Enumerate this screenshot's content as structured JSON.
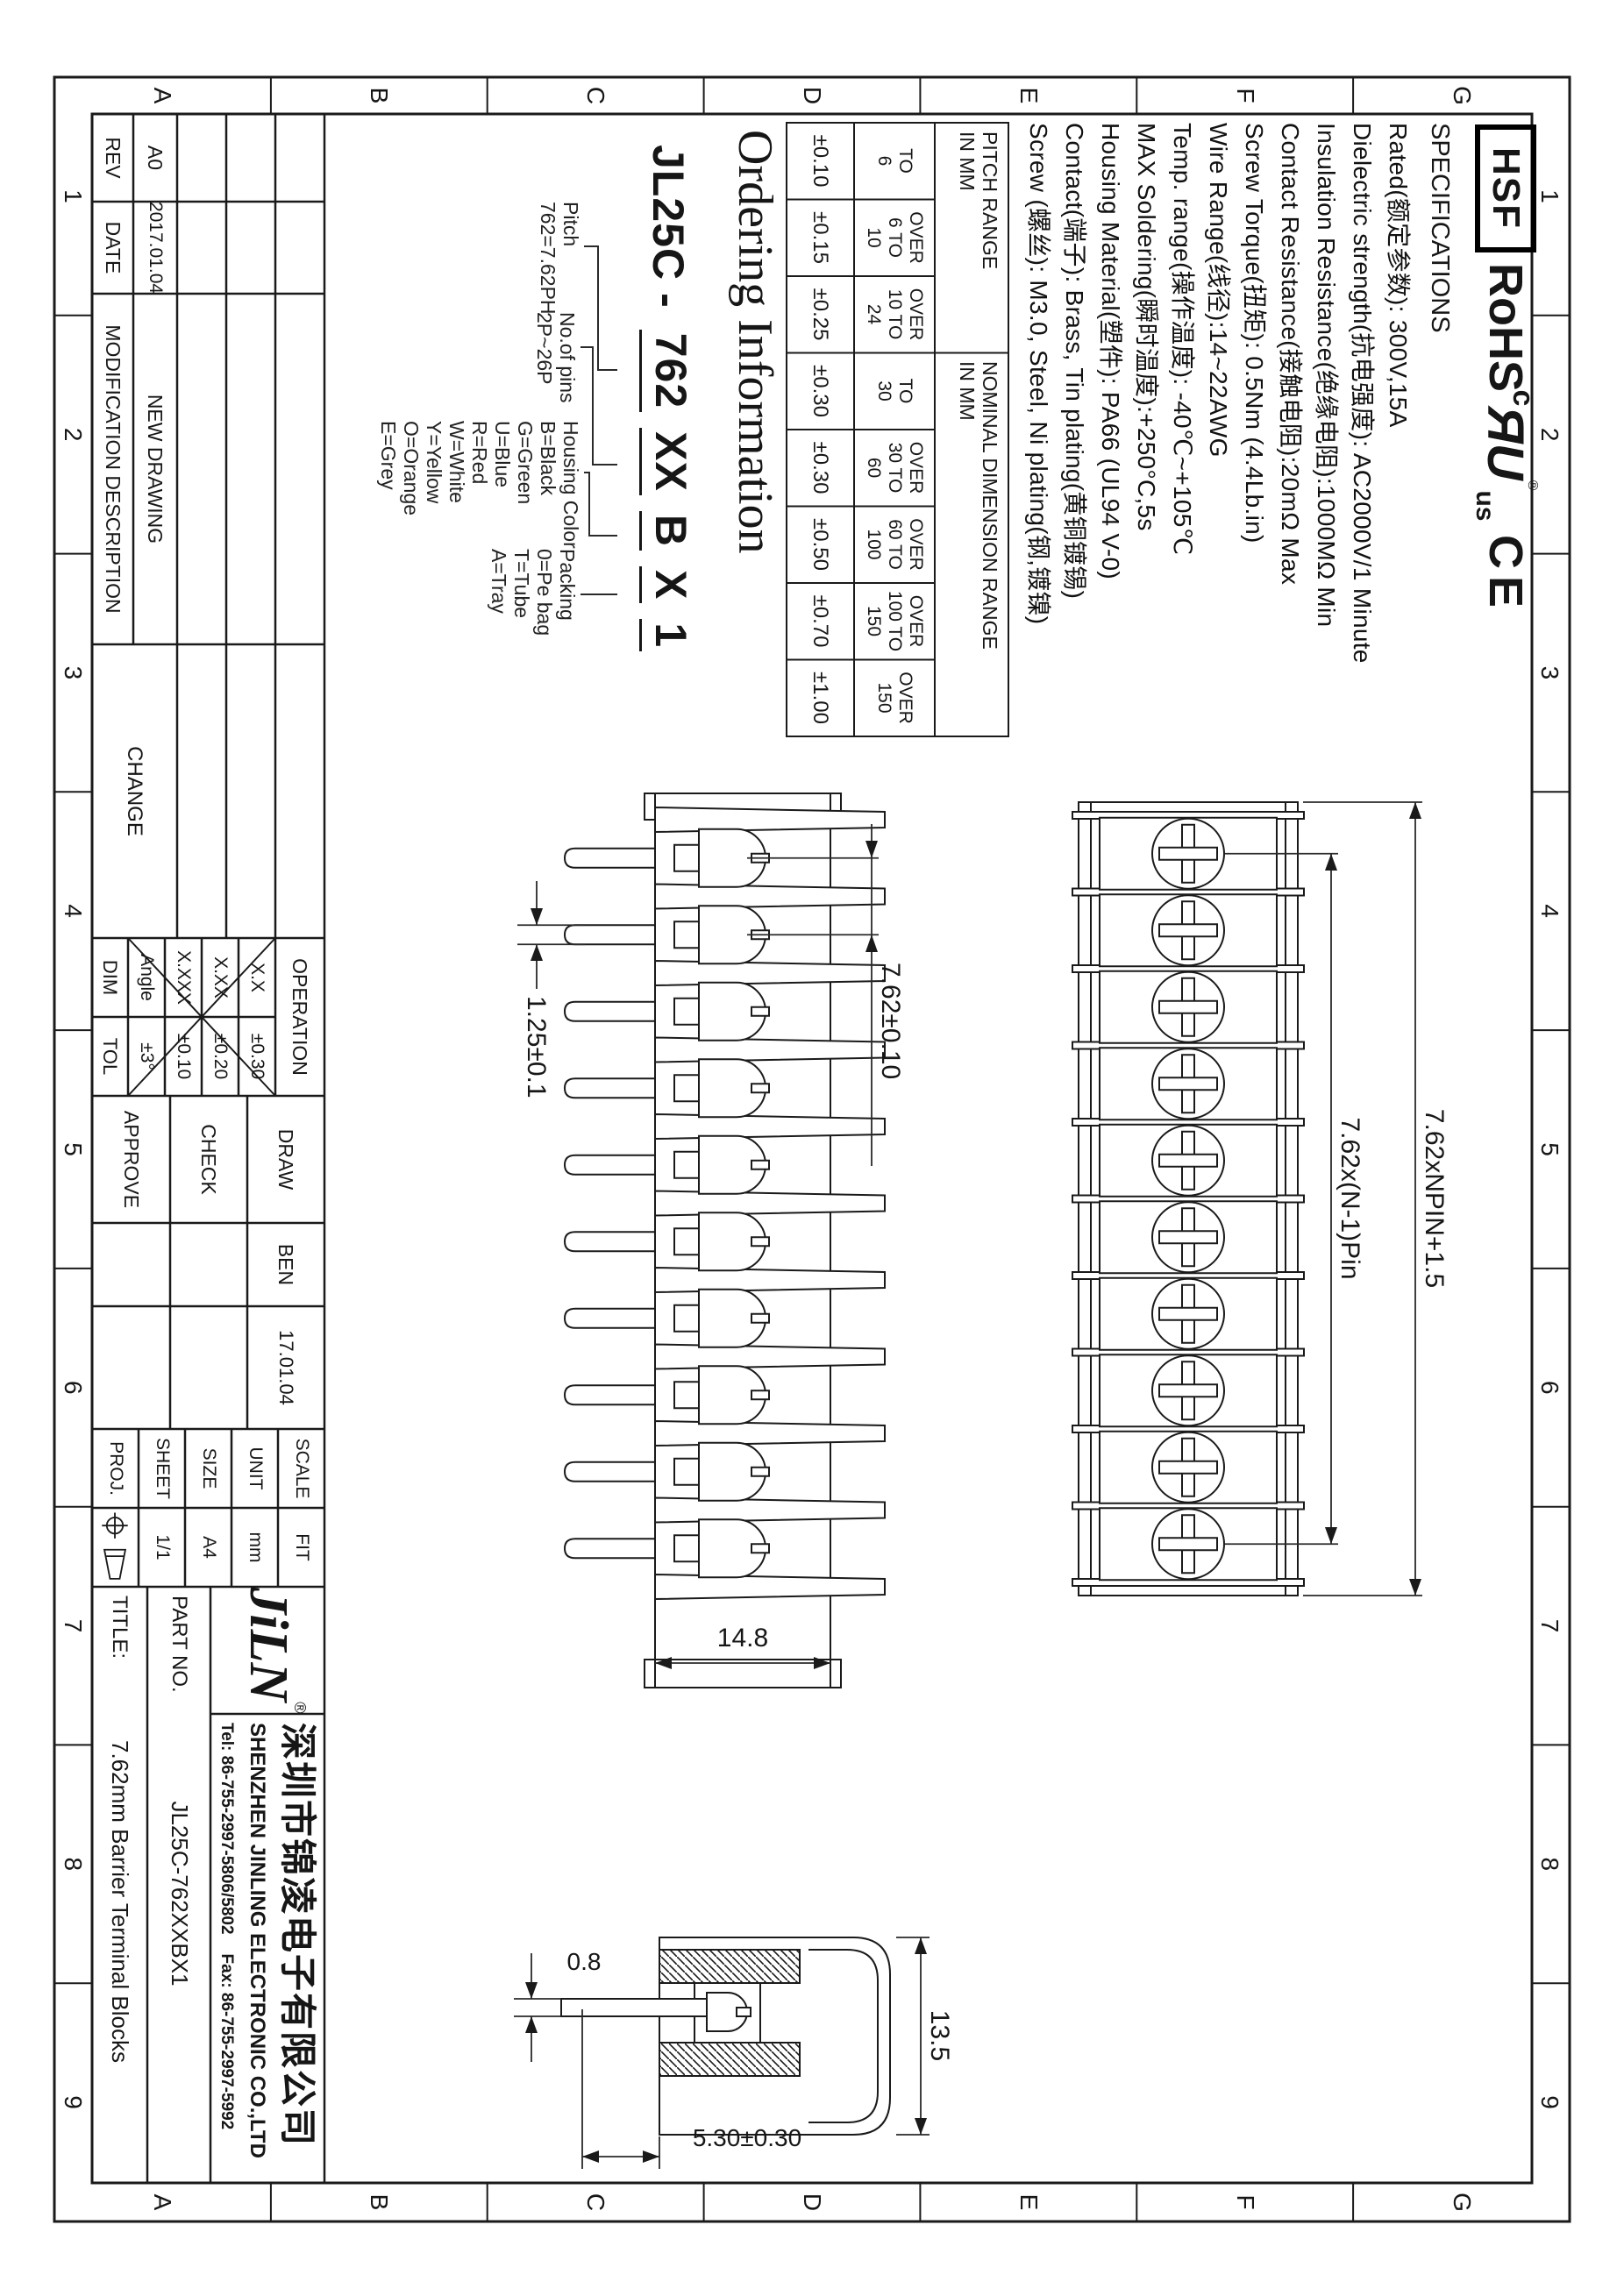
{
  "zones": {
    "letters": [
      "A",
      "B",
      "C",
      "D",
      "E",
      "F",
      "G"
    ],
    "numbers": [
      "1",
      "2",
      "3",
      "4",
      "5",
      "6",
      "7",
      "8",
      "9"
    ]
  },
  "logos": {
    "hsf": "HSF",
    "rohs": "RoHS",
    "ul_c": "c",
    "ul_ru": "ЯU",
    "ul_reg": "®",
    "ul_us": "us",
    "ce": "CE"
  },
  "specs": {
    "title": "SPECIFICATIONS",
    "lines": [
      "Rated(额定参数): 300V,15A",
      "Dielectric strength(抗电强度): AC2000V/1 Minute",
      "Insulation Resistance(绝缘电阻):1000MΩ Min",
      "Contact Resistance(接触电阻):20mΩ Max",
      "Screw Torque(扭矩): 0.5Nm (4.4Lb.in)",
      "Wire Range(线径):14~22AWG",
      "Temp. range(操作温度): -40℃~+105℃",
      "MAX Soldering(瞬时温度):+250°C,5s",
      "Housing Material(塑件): PA66 (UL94 V-0)",
      "Contact(端子): Brass, Tin plating(黄铜镀锡)",
      "Screw (螺丝): M3.0, Steel, Ni plating(钢,镀镍)"
    ]
  },
  "range_table": {
    "pitch_header": "PITCH RANGE\nIN MM",
    "nominal_header": "NOMINAL DIMENSION RANGE\nIN MM",
    "cols": [
      {
        "range": "TO\n6",
        "tol": "±0.10"
      },
      {
        "range": "OVER\n6 TO\n10",
        "tol": "±0.15"
      },
      {
        "range": "OVER\n10 TO\n24",
        "tol": "±0.25"
      },
      {
        "range": "TO\n30",
        "tol": "±0.30"
      },
      {
        "range": "OVER\n30 TO\n60",
        "tol": "±0.30"
      },
      {
        "range": "OVER\n60 TO\n100",
        "tol": "±0.50"
      },
      {
        "range": "OVER\n100 TO\n150",
        "tol": "±0.70"
      },
      {
        "range": "OVER\n150",
        "tol": "±1.00"
      }
    ]
  },
  "ordering": {
    "heading": "Ordering Information",
    "prefix": "JL25C",
    "dash": "-",
    "segments": [
      "762",
      "XX",
      "B",
      "X",
      "1"
    ],
    "groups": [
      {
        "title": "Pitch",
        "lines": [
          "762=7.62PH"
        ]
      },
      {
        "title": "No.of pins",
        "lines": [
          "2P~26P"
        ]
      },
      {
        "title": "Housing Color",
        "lines": [
          "B=Black",
          "G=Green",
          "U=Blue",
          "R=Red",
          "W=White",
          "Y=Yellow",
          "O=Orange",
          "E=Grey"
        ]
      },
      {
        "title": "Packing",
        "lines": [
          "0=Pe bag",
          "T=Tube",
          "A=Tray"
        ]
      }
    ]
  },
  "views": {
    "poles": 10,
    "dims": {
      "pitch": "7.62±0.10",
      "pin_width": "1.25±0.1",
      "body_width": "14.8",
      "span_inner": "7.62x(N-1)Pin",
      "span_outer": "7.62xNPIN+1.5",
      "pin_thickness": "0.8",
      "height": "13.5",
      "pin_offset": "5.30±0.30"
    }
  },
  "revision_table": {
    "rev_label": "REV",
    "date_label": "DATE",
    "desc_label": "MODIFICATION DESCRIPTION",
    "change_label": "CHANGE",
    "rev": "A0",
    "date": "2017.01.04",
    "desc": "NEW DRAWING"
  },
  "tolerance_table": {
    "header": "OPERATION",
    "dim_label": "DIM",
    "tol_label": "TOL",
    "rows": [
      {
        "dim": "X.X",
        "tol": "±0.30"
      },
      {
        "dim": "X.XX",
        "tol": "±0.20"
      },
      {
        "dim": "X.XXX",
        "tol": "±0.10"
      },
      {
        "dim": "Angle",
        "tol": "±3°"
      }
    ]
  },
  "sign_table": {
    "draw_label": "DRAW",
    "check_label": "CHECK",
    "approve_label": "APPROVE",
    "draw_name": "BEN",
    "draw_date": "17.01.04"
  },
  "info_table": {
    "scale_label": "SCALE",
    "scale": "FIT",
    "unit_label": "UNIT",
    "unit": "mm",
    "size_label": "SIZE",
    "size": "A4",
    "sheet_label": "SHEET",
    "sheet": "1/1",
    "proj_label": "PROJ."
  },
  "company": {
    "logo": "JiLN",
    "reg": "®",
    "name_cn": "深圳市锦凌电子有限公司",
    "name_en": "SHENZHEN JINLING ELECTRONIC CO.,LTD",
    "tel": "Tel: 86-755-2997-5806/5802",
    "fax": "Fax: 86-755-2997-5992",
    "part_no_label": "PART NO.",
    "part_no": "JL25C-762XXBX1",
    "title_label": "TITLE:",
    "title": "7.62mm Barrier Terminal Blocks"
  }
}
